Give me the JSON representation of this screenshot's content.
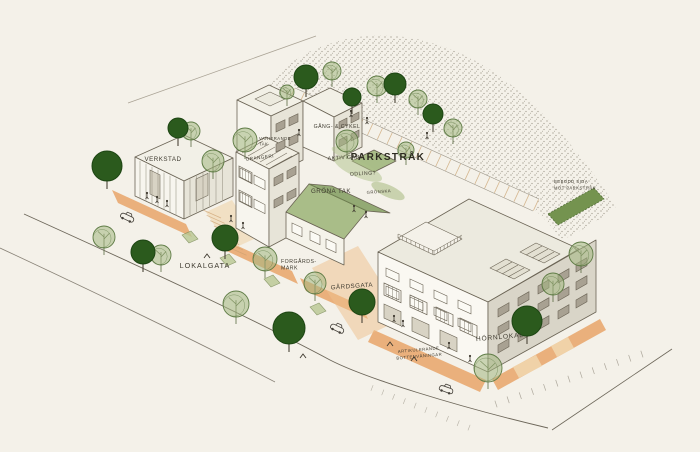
{
  "scene": {
    "type": "hand-drawn axonometric urban block sketch",
    "background": "#f4f1e9"
  },
  "palette": {
    "paper": "#f4f1e9",
    "ink": "#6b6455",
    "label": "#3e3a2f",
    "orange": "#e7a468",
    "tan": "#efd2a6",
    "green_roof": "#a9bd88",
    "green_roof_dark": "#93aa74",
    "green_hedge": "#74934f",
    "tree_dark": "#2b5a1d",
    "tree_light": "#a3b77f",
    "stipple": "#8b8577"
  },
  "labels": {
    "verkstad": "VERKSTAD",
    "varierande_tak_line1": "VARIERANDE",
    "varierande_tak_line2": "TAK",
    "orangeri": "ORANGERI",
    "gang_cykel": "GÅNG- & CYKEL",
    "parkstrak": "PARKSTRÅK",
    "aktiv_gard": "AKTIV GÅRD",
    "odling": "ODLING?",
    "gronska": "GRÖNSKA",
    "grona_tak": "GRÖNA TAK",
    "bebodd_line1": "BEBODD SIDA",
    "bebodd_line2": "MOT PARKSTRÅK",
    "lokalgata": "LOKALGATA",
    "forgards_line1": "FORGÅRDS-",
    "forgards_line2": "MARK",
    "gardsgata": "GÅRDSGATA",
    "artikulerande_line1": "ARTIKULERANDE",
    "artikulerande_line2": "BOTTENVÅNINGAR",
    "hornlokal": "HÖRNLOKAL"
  },
  "trees": {
    "dark": [
      {
        "x": 306,
        "y": 77,
        "r": 12
      },
      {
        "x": 352,
        "y": 97,
        "r": 9
      },
      {
        "x": 395,
        "y": 84,
        "r": 11
      },
      {
        "x": 433,
        "y": 114,
        "r": 10
      },
      {
        "x": 107,
        "y": 166,
        "r": 15
      },
      {
        "x": 178,
        "y": 128,
        "r": 10
      },
      {
        "x": 143,
        "y": 252,
        "r": 12
      },
      {
        "x": 225,
        "y": 238,
        "r": 13
      },
      {
        "x": 289,
        "y": 328,
        "r": 16
      },
      {
        "x": 362,
        "y": 302,
        "r": 13
      },
      {
        "x": 527,
        "y": 321,
        "r": 15
      }
    ],
    "light": [
      {
        "x": 332,
        "y": 71,
        "r": 9
      },
      {
        "x": 377,
        "y": 86,
        "r": 10
      },
      {
        "x": 418,
        "y": 99,
        "r": 9
      },
      {
        "x": 453,
        "y": 128,
        "r": 9
      },
      {
        "x": 287,
        "y": 92,
        "r": 7
      },
      {
        "x": 347,
        "y": 141,
        "r": 11
      },
      {
        "x": 191,
        "y": 131,
        "r": 9
      },
      {
        "x": 213,
        "y": 161,
        "r": 11
      },
      {
        "x": 245,
        "y": 140,
        "r": 12
      },
      {
        "x": 104,
        "y": 237,
        "r": 11
      },
      {
        "x": 161,
        "y": 255,
        "r": 10
      },
      {
        "x": 236,
        "y": 304,
        "r": 13
      },
      {
        "x": 265,
        "y": 259,
        "r": 12
      },
      {
        "x": 315,
        "y": 283,
        "r": 11
      },
      {
        "x": 488,
        "y": 368,
        "r": 14
      },
      {
        "x": 553,
        "y": 284,
        "r": 11
      },
      {
        "x": 581,
        "y": 254,
        "r": 12
      },
      {
        "x": 406,
        "y": 150,
        "r": 8
      }
    ]
  },
  "figures": {
    "people": [
      [
        351,
        111
      ],
      [
        367,
        118
      ],
      [
        299,
        130
      ],
      [
        427,
        133
      ],
      [
        354,
        206
      ],
      [
        366,
        212
      ],
      [
        147,
        193
      ],
      [
        157,
        197
      ],
      [
        167,
        201
      ],
      [
        231,
        216
      ],
      [
        243,
        223
      ],
      [
        394,
        316
      ],
      [
        403,
        321
      ],
      [
        449,
        343
      ],
      [
        470,
        356
      ]
    ],
    "cars": [
      {
        "x": 127,
        "y": 218,
        "angle": 25
      },
      {
        "x": 337,
        "y": 329,
        "angle": 26
      },
      {
        "x": 446,
        "y": 390,
        "angle": 20
      }
    ],
    "birds": [
      [
        207,
        256
      ],
      [
        303,
        356
      ],
      [
        390,
        344
      ],
      [
        414,
        359
      ]
    ]
  }
}
